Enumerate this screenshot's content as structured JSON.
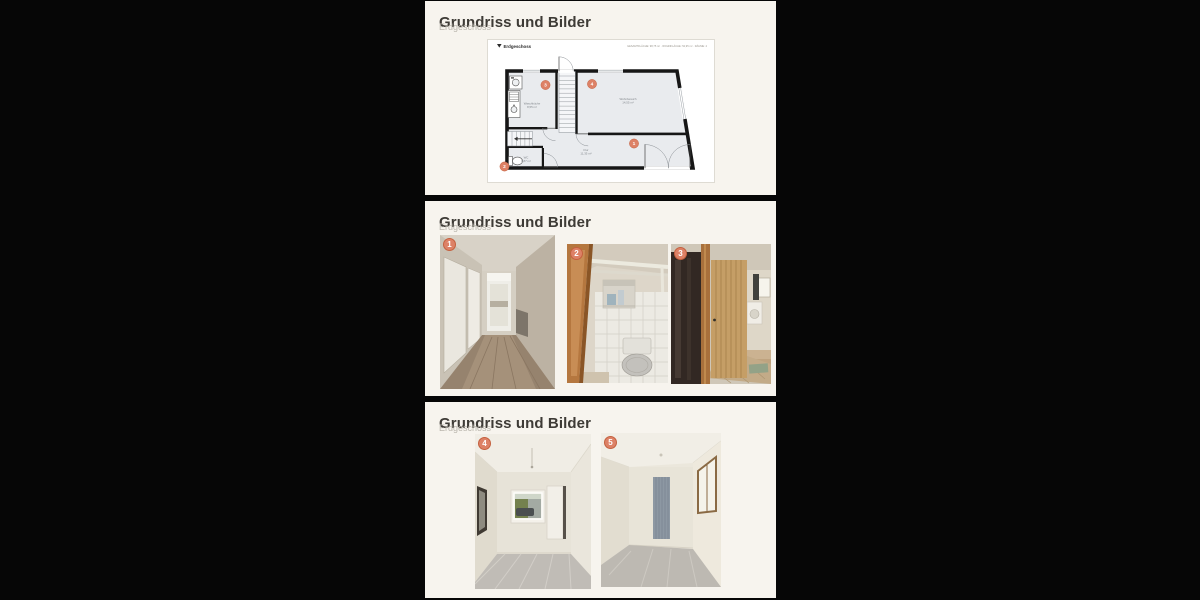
{
  "theme": {
    "page_bg": "#060606",
    "card_bg": "#f7f4ee",
    "title_color": "#3e3b36",
    "subtitle_color": "#bab6ad",
    "badge_bg": "#dd8166",
    "badge_ring": "#c4613f",
    "badge_text": "#ffffff",
    "plan_floor": "#e9ebee",
    "plan_wall": "#161616"
  },
  "sections": [
    {
      "title": "Grundriss und Bilder",
      "subtitle": "Erdgeschoss"
    },
    {
      "title": "Grundriss und Bilder",
      "subtitle": "Erdgeschoss"
    },
    {
      "title": "Grundriss und Bilder",
      "subtitle": "Erdgeschoss"
    }
  ],
  "floorplan": {
    "level_icon": "▼",
    "level_label": "Erdgeschoss",
    "stats": "GESAMTFLÄCHE: 98,75 m² · WOHNFLÄCHE: 52,95 m² · RÄUME: 4",
    "rooms": [
      {
        "marker": "3",
        "name": "Waschküche",
        "area": "8,55 m²"
      },
      {
        "marker": "4",
        "name": "Wohnbereich",
        "area": "14,55 m²"
      },
      {
        "marker": "1",
        "name": "Flur",
        "area": "11,35 m²"
      },
      {
        "marker": "2",
        "name": "WC",
        "area": "0,87 m²"
      }
    ]
  },
  "photo_markers": {
    "p1": "1",
    "p2": "2",
    "p3": "3",
    "p4": "4",
    "p5": "5"
  }
}
